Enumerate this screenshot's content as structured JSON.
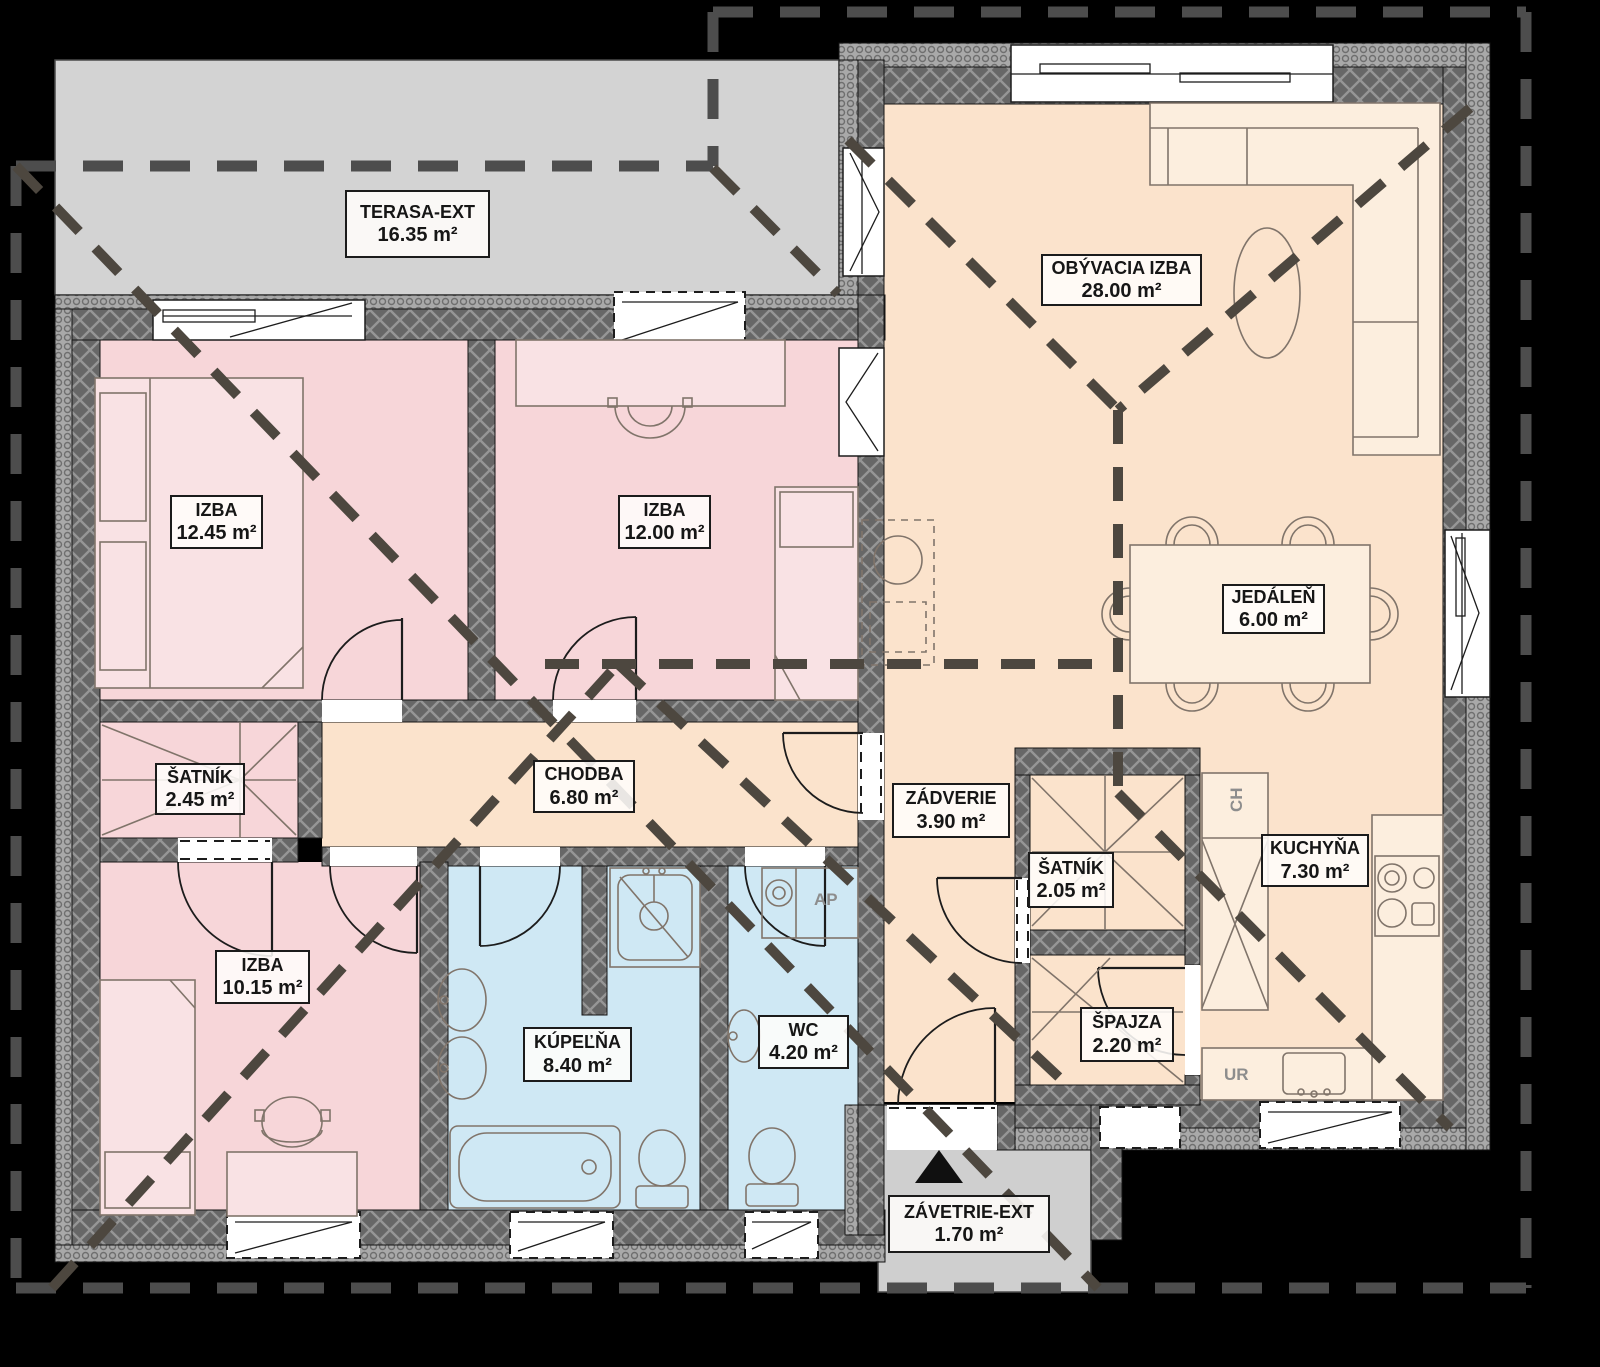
{
  "plan": {
    "type": "floor-plan",
    "language": "sk",
    "area_unit": "m²",
    "rooms": [
      {
        "key": "terasa",
        "name": "TERASA-EXT",
        "area": "16.35 m²",
        "zone": "exterior"
      },
      {
        "key": "obyvacia",
        "name": "OBÝVACIA IZBA",
        "area": "28.00 m²",
        "zone": "living"
      },
      {
        "key": "izba-1245",
        "name": "IZBA",
        "area": "12.45 m²",
        "zone": "bedroom"
      },
      {
        "key": "izba-1200",
        "name": "IZBA",
        "area": "12.00 m²",
        "zone": "bedroom"
      },
      {
        "key": "jedalen",
        "name": "JEDÁLEŇ",
        "area": "6.00 m²",
        "zone": "dining"
      },
      {
        "key": "satnik-245",
        "name": "ŠATNÍK",
        "area": "2.45 m²",
        "zone": "closet"
      },
      {
        "key": "chodba",
        "name": "CHODBA",
        "area": "6.80 m²",
        "zone": "hall"
      },
      {
        "key": "zadverie",
        "name": "ZÁDVERIE",
        "area": "3.90 m²",
        "zone": "entry"
      },
      {
        "key": "satnik-205",
        "name": "ŠATNÍK",
        "area": "2.05 m²",
        "zone": "closet"
      },
      {
        "key": "kuchyna",
        "name": "KUCHYŇA",
        "area": "7.30 m²",
        "zone": "kitchen"
      },
      {
        "key": "izba-1015",
        "name": "IZBA",
        "area": "10.15 m²",
        "zone": "bedroom"
      },
      {
        "key": "kupelna",
        "name": "KÚPEĽŇA",
        "area": "8.40 m²",
        "zone": "bathroom"
      },
      {
        "key": "wc",
        "name": "WC",
        "area": "4.20 m²",
        "zone": "toilet"
      },
      {
        "key": "spajza",
        "name": "ŠPAJZA",
        "area": "2.20 m²",
        "zone": "pantry"
      },
      {
        "key": "zavetrie",
        "name": "ZÁVETRIE-EXT",
        "area": "1.70 m²",
        "zone": "exterior"
      }
    ],
    "appliance_labels": {
      "fridge": "CH",
      "utility_sink": "UR",
      "washing_machine": "AP"
    },
    "colors": {
      "room_pink": "#f7d6d9",
      "room_peach": "#fbe3cc",
      "room_blue": "#cfe8f4",
      "exterior_gray": "#d3d3d3",
      "wall_gray": "#676767",
      "background": "#000000"
    }
  }
}
